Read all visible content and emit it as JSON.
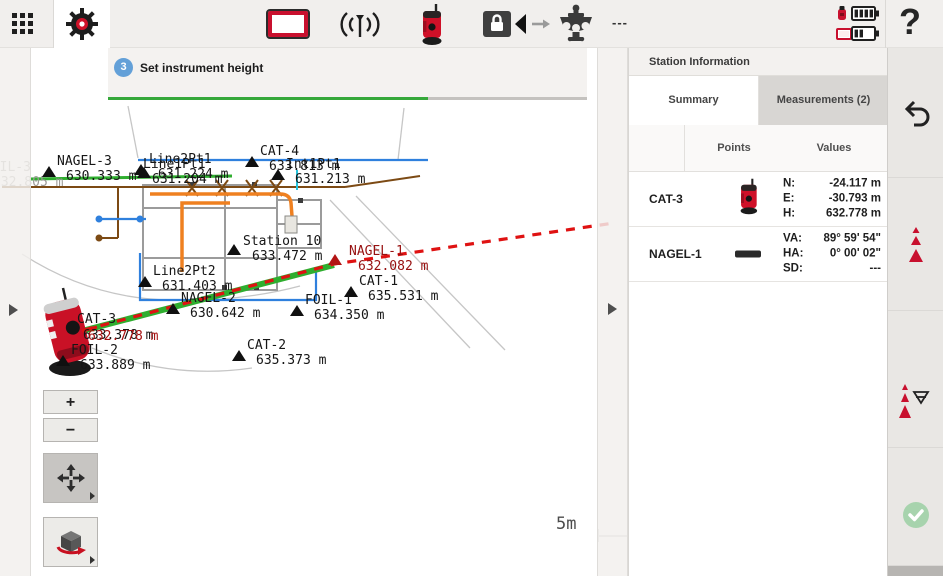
{
  "toolbar": {
    "status_dashes": "---",
    "help_label": "?"
  },
  "wizard": {
    "step_number": "3",
    "title": "Set instrument height"
  },
  "map": {
    "zoom_in_label": "+",
    "zoom_out_label": "−",
    "scale_label": "5m",
    "points": [
      {
        "name": "FOIL-3",
        "value": "632.805 m"
      },
      {
        "name": "NAGEL-3",
        "value": "630.333 m"
      },
      {
        "name": "Line2Pt1",
        "value": "631.224 m"
      },
      {
        "name": "Line1Pt1",
        "value": "631.204 m"
      },
      {
        "name": "CAT-4",
        "value": "633.813 m"
      },
      {
        "name": "Int1Pt1",
        "value": "631.213 m"
      },
      {
        "name": "Station 10",
        "value": "633.472 m"
      },
      {
        "name": "NAGEL-1",
        "value": "632.082 m"
      },
      {
        "name": "Line2Pt2",
        "value": "631.403 m"
      },
      {
        "name": "NAGEL-2",
        "value": "630.642 m"
      },
      {
        "name": "CAT-1",
        "value": "635.531 m"
      },
      {
        "name": "FOIL-1",
        "value": "634.350 m"
      },
      {
        "name": "CAT-3",
        "value": "632.778 m",
        "overlap_value": "633.378 m"
      },
      {
        "name": "FOIL-2",
        "value": "633.889 m"
      },
      {
        "name": "CAT-2",
        "value": "635.373 m"
      }
    ]
  },
  "panel": {
    "title": "Station Information",
    "tabs": [
      {
        "label": "Summary"
      },
      {
        "label": "Measurements (2)"
      }
    ],
    "columns": {
      "points": "Points",
      "values": "Values"
    },
    "rows": [
      {
        "name": "CAT-3",
        "values": [
          {
            "label": "N:",
            "value": "-24.117 m"
          },
          {
            "label": "E:",
            "value": "-30.793 m"
          },
          {
            "label": "H:",
            "value": "632.778 m"
          }
        ]
      },
      {
        "name": "NAGEL-1",
        "values": [
          {
            "label": "VA:",
            "value": "89° 59' 54\""
          },
          {
            "label": "HA:",
            "value": "0° 00' 02\""
          },
          {
            "label": "SD:",
            "value": "---"
          }
        ]
      }
    ]
  },
  "icons": {
    "toolbar": [
      "apps-grid-icon",
      "settings-gear-icon",
      "display-icon",
      "radio-signal-icon",
      "total-station-icon",
      "lock-track-icon",
      "tribrach-icon",
      "instrument-battery-icon",
      "controller-battery-icon",
      "help-icon"
    ],
    "map": [
      "zoom-in",
      "zoom-out",
      "pan-icon",
      "rotate-3d-icon",
      "instrument-icon",
      "point-marker"
    ],
    "sidebar": [
      "undo-icon",
      "target-points-icon",
      "set-orientation-icon",
      "confirm-check-icon"
    ]
  },
  "colors": {
    "accent_red": "#c8102e",
    "progress_green": "#35a83a",
    "measure_green": "#2fae2f",
    "dash_red": "#df1212",
    "check_green": "#a7d3ad"
  }
}
